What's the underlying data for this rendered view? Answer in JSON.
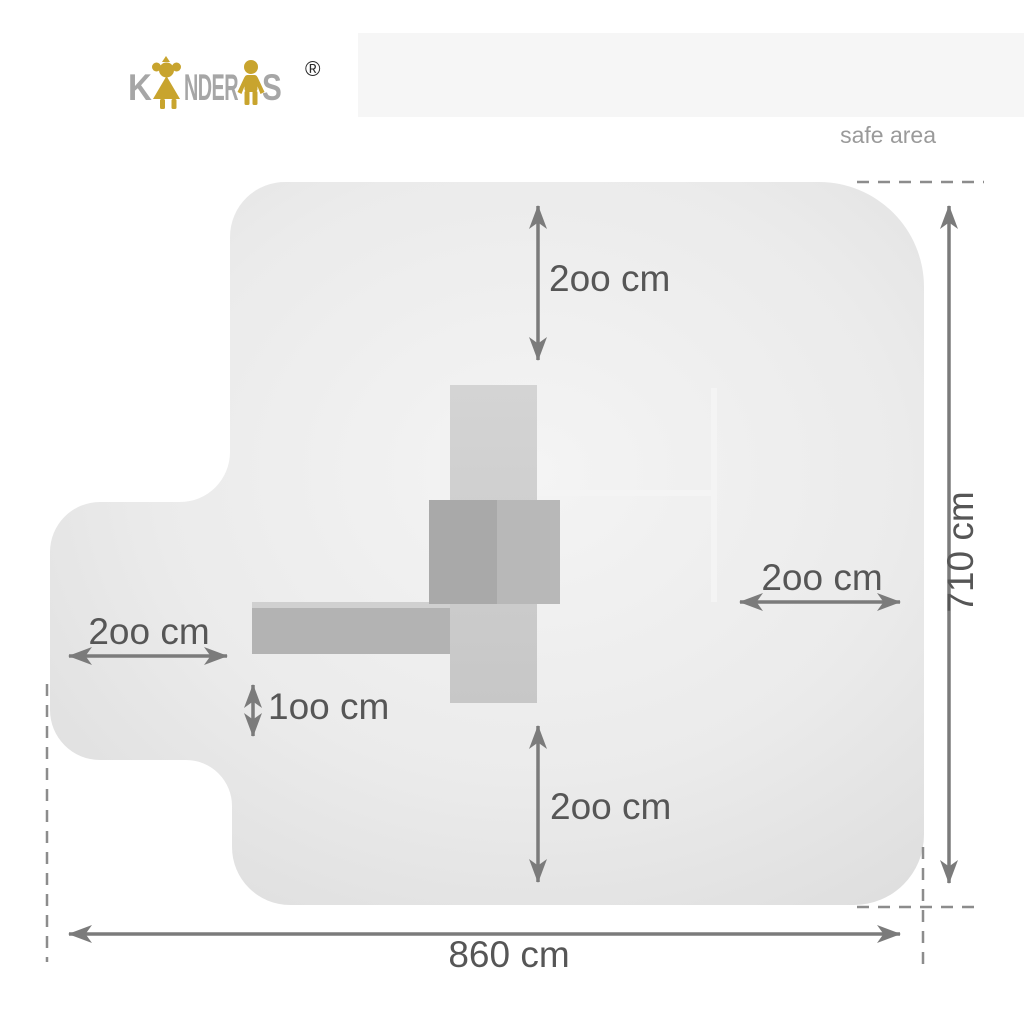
{
  "brand": {
    "logo_part_k": "K",
    "logo_part_nder": "NDER",
    "logo_part_s": "S",
    "registered_mark": "®",
    "girl_icon": "girl-figure",
    "boy_icon": "boy-figure",
    "letter_color": "#a6a6a6",
    "figure_gold": "#c8a42e"
  },
  "header": {
    "note": "safe area"
  },
  "diagram": {
    "unit": "cm",
    "labels": {
      "top_clearance": "2oo cm",
      "right_clearance": "2oo cm",
      "left_clearance": "2oo cm",
      "slide_clearance": "1oo cm",
      "bottom_clearance": "2oo cm",
      "total_width": "860 cm",
      "total_height": "710 cm"
    },
    "values_cm": {
      "top_clearance": 200,
      "right_clearance": 200,
      "left_clearance": 200,
      "slide_clearance": 100,
      "bottom_clearance": 200,
      "total_width": 860,
      "total_height": 710
    },
    "colors": {
      "safe_area_fill_center": "#f3f3f3",
      "safe_area_fill_edge": "#dedede",
      "dimension_line": "#7b7b7b",
      "dashed_line": "#8c8c8c",
      "label_text": "#565656",
      "tower_fill": "#cecece",
      "platform_dark": "#a9a9a9",
      "platform_mid": "#b8b8b8",
      "arm_fill": "#b3b3b3",
      "frame_line": "#f4f4f4",
      "top_band": "#f6f6f6"
    }
  }
}
